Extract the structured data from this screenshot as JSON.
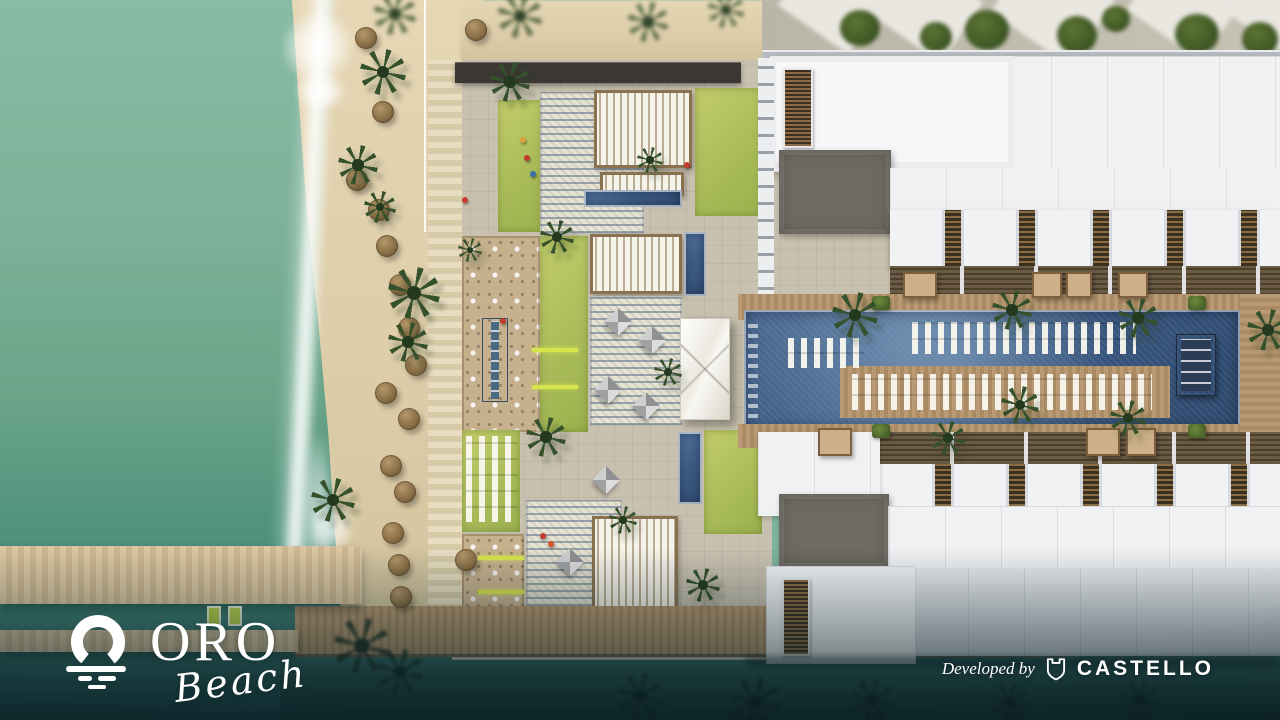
{
  "branding": {
    "logo_text": "ORO",
    "logo_subtext": "Beach",
    "logo_icon": "sun-over-waves-icon"
  },
  "credit": {
    "prefix": "Developed by",
    "developer_name": "CASTELLO",
    "icon": "castello-shield-icon"
  },
  "palette": {
    "sea_light": "#8abba4",
    "sea_deep": "#2b5f5e",
    "sand": "#ddcda9",
    "lawn_green": "#a9bb59",
    "pool_blue": "#3d5c84",
    "wood_deck": "#aa8b63",
    "paving": "#c9c1b0",
    "plaza_mosaic_blue": "#566e86",
    "plaza_mosaic_cream": "#e8e2d0",
    "building_white": "#f0f1f3",
    "roof_gray": "#6f6b63",
    "text_white": "#ffffff"
  }
}
